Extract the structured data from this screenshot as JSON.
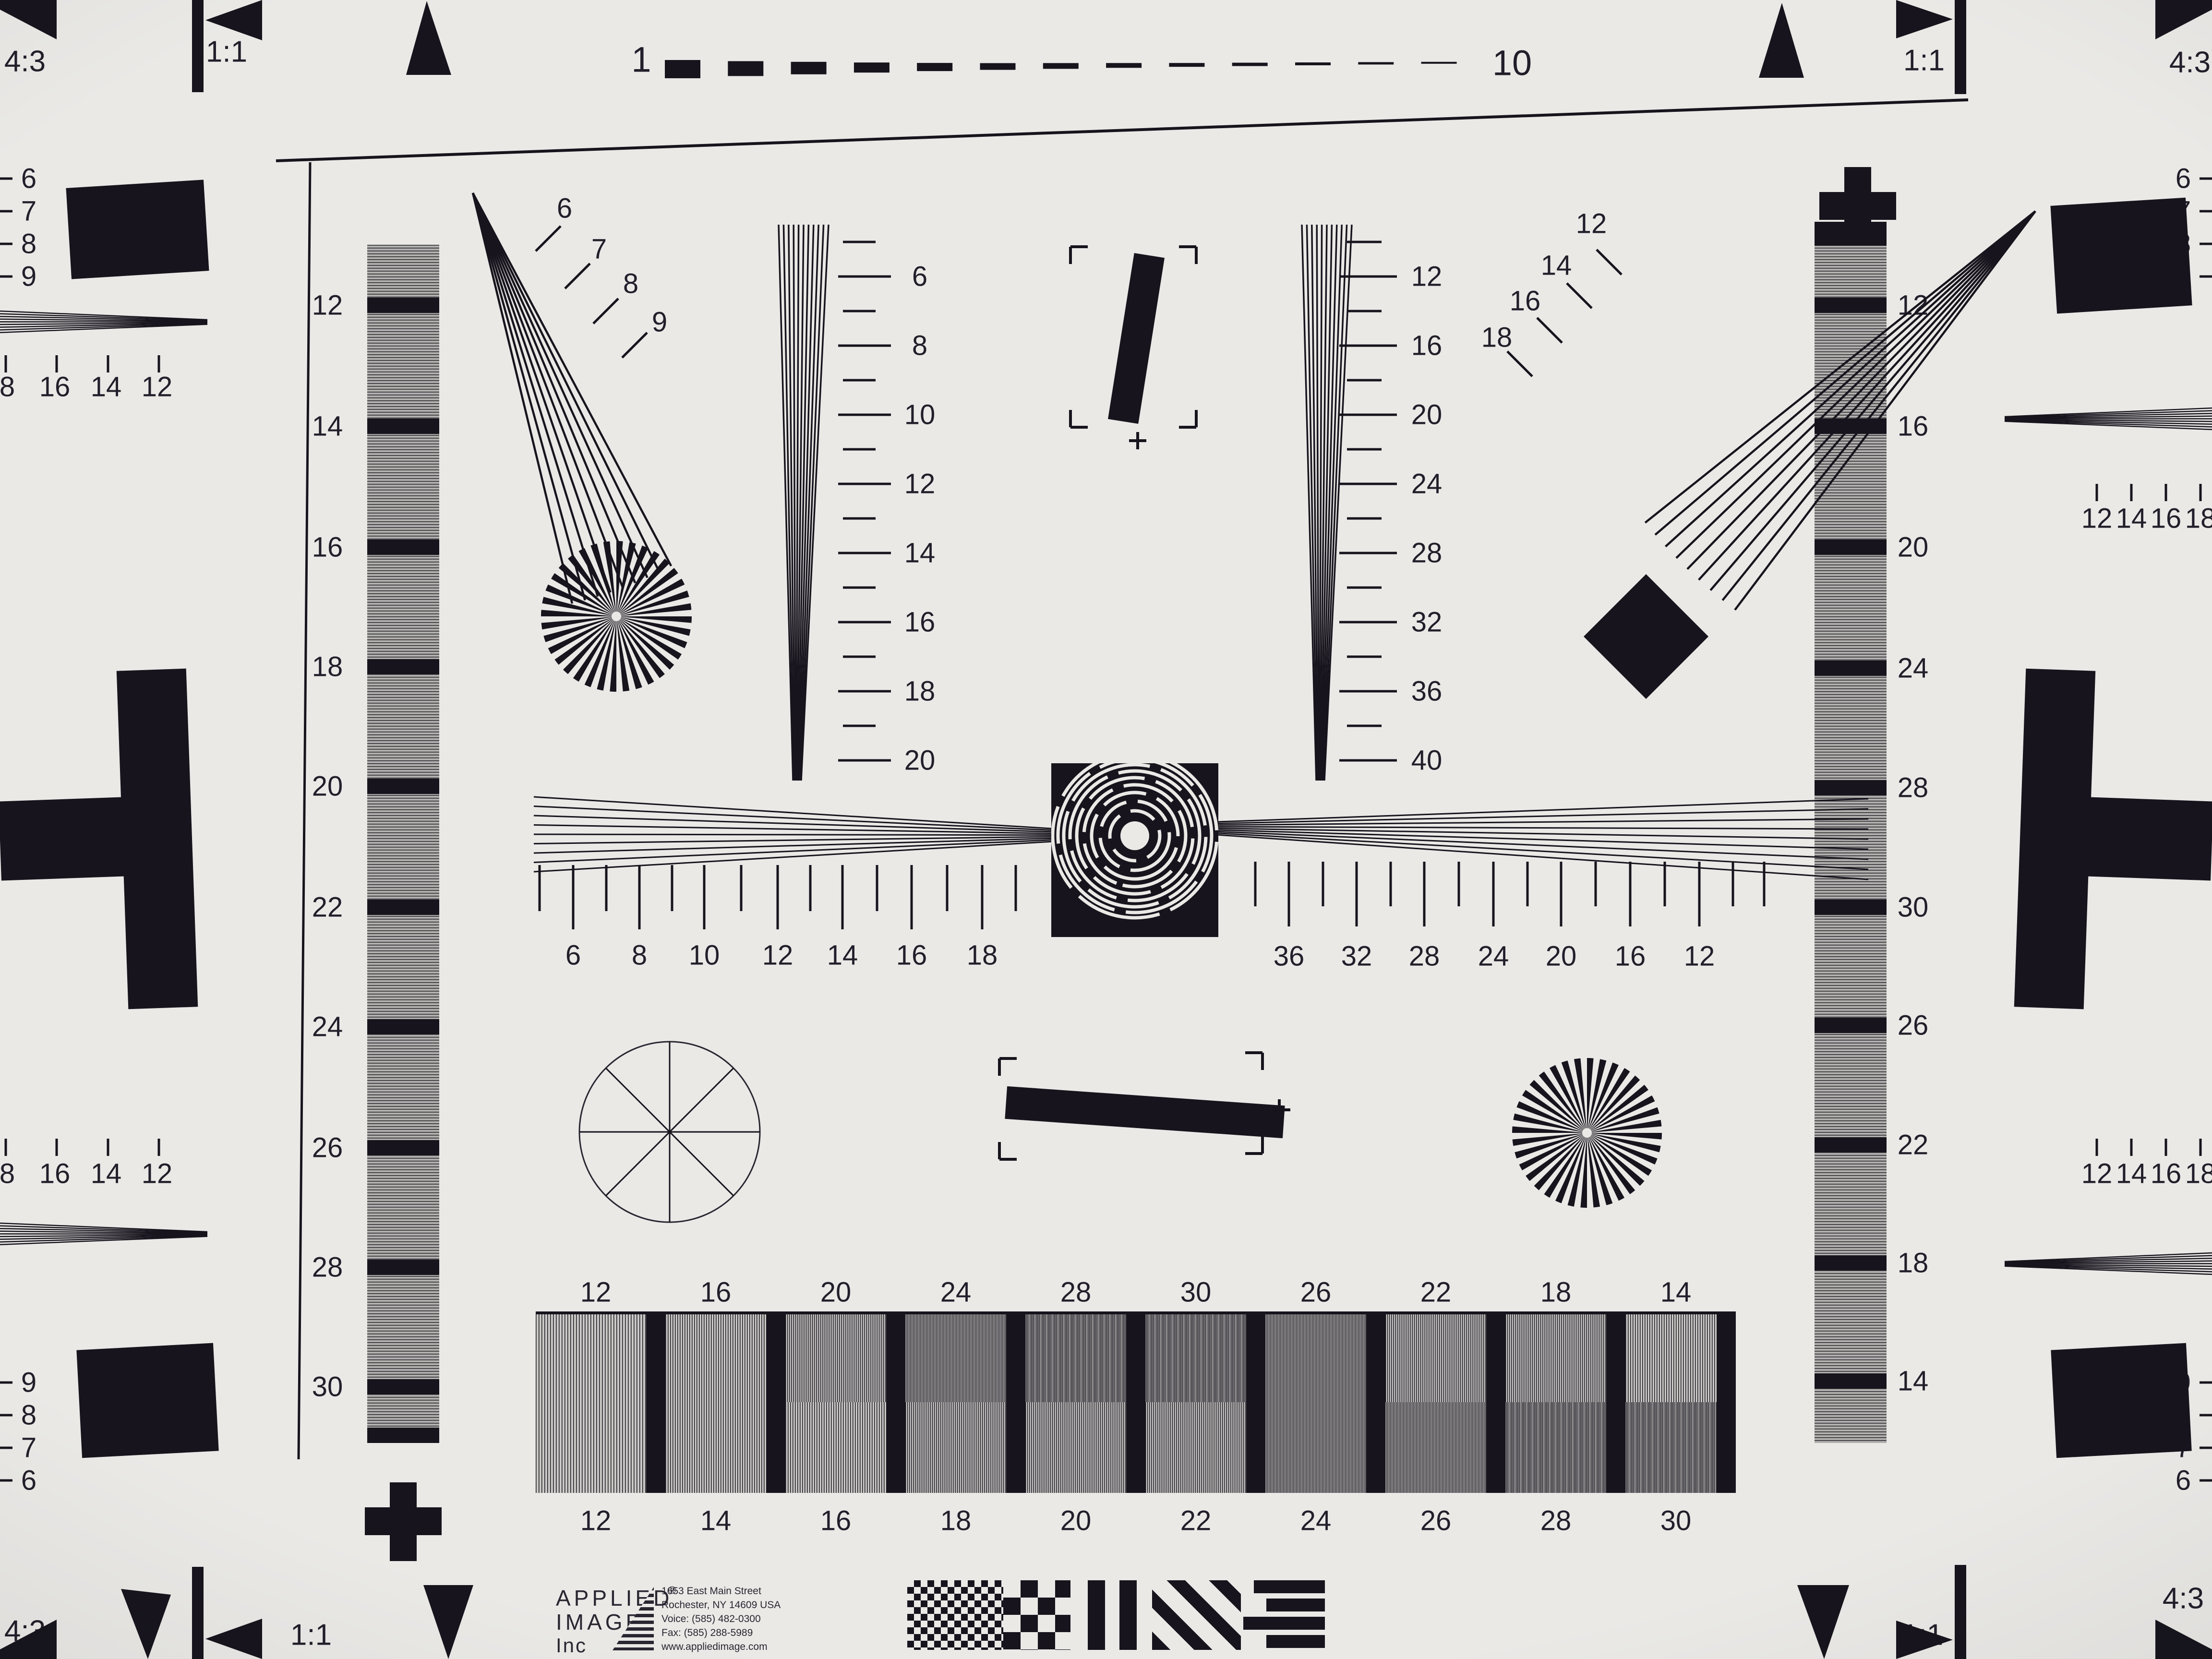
{
  "colors": {
    "background": "#eae9e6",
    "ink": "#17141d",
    "strip_gray": "#8e8d8a",
    "grid_gray": "#c9c8c5"
  },
  "corners": {
    "top_left_ratio": "4:3",
    "top_left_square": "1:1",
    "top_right_square": "1:1",
    "top_right_ratio": "4:3",
    "bottom_left_ratio": "4:3",
    "bottom_left_square": "1:1",
    "bottom_right_square": "1:1",
    "bottom_right_ratio": "4:3"
  },
  "top_ruler": {
    "start_label": "1",
    "end_label": "10",
    "dash_count": 13
  },
  "left_strip": {
    "labels": [
      "12",
      "14",
      "16",
      "18",
      "20",
      "22",
      "24",
      "26",
      "28",
      "30"
    ]
  },
  "right_strip": {
    "labels": [
      "12",
      "16",
      "20",
      "24",
      "28",
      "30",
      "26",
      "22",
      "18",
      "14"
    ]
  },
  "tl_fan": {
    "labels": [
      "6",
      "7",
      "8",
      "9"
    ]
  },
  "tr_fan": {
    "labels": [
      "12",
      "14",
      "16",
      "18"
    ]
  },
  "left_vertical_scale": {
    "labels": [
      "6",
      "8",
      "10",
      "12",
      "14",
      "16",
      "18",
      "20"
    ]
  },
  "right_vertical_scale": {
    "labels": [
      "12",
      "16",
      "20",
      "24",
      "28",
      "32",
      "36",
      "40"
    ]
  },
  "center_scale_left": {
    "labels": [
      "6",
      "8",
      "10",
      "12",
      "14",
      "16",
      "18"
    ]
  },
  "center_scale_right": {
    "labels": [
      "36",
      "32",
      "28",
      "24",
      "20",
      "16",
      "12"
    ]
  },
  "grid": {
    "top_labels": [
      "12",
      "16",
      "20",
      "24",
      "28",
      "30",
      "26",
      "22",
      "18",
      "14"
    ],
    "bottom_labels": [
      "12",
      "14",
      "16",
      "18",
      "20",
      "22",
      "24",
      "26",
      "28",
      "30"
    ]
  },
  "edges": {
    "left_top_numbers": [
      "6",
      "7",
      "8",
      "9"
    ],
    "left_bottom_numbers": [
      "9",
      "8",
      "7",
      "6"
    ],
    "left_top_ticks": [
      "8",
      "16",
      "14",
      "12"
    ],
    "left_bottom_ticks": [
      "8",
      "16",
      "14",
      "12"
    ],
    "right_top_numbers": [
      "6",
      "7",
      "8",
      "9"
    ],
    "right_bottom_numbers": [
      "9",
      "8",
      "7",
      "6"
    ],
    "right_top_ticks": [
      "12",
      "14",
      "16",
      "18"
    ],
    "right_bottom_ticks": [
      "12",
      "14",
      "16",
      "18"
    ]
  },
  "logo": {
    "word1": "APPLIED",
    "registered": "®",
    "word2": "IMAGE",
    "word3": "Inc",
    "address": [
      "1653 East Main Street",
      "Rochester, NY  14609  USA",
      "Voice:   (585) 482-0300",
      "Fax:      (585) 288-5989",
      "www.appliedimage.com"
    ]
  }
}
